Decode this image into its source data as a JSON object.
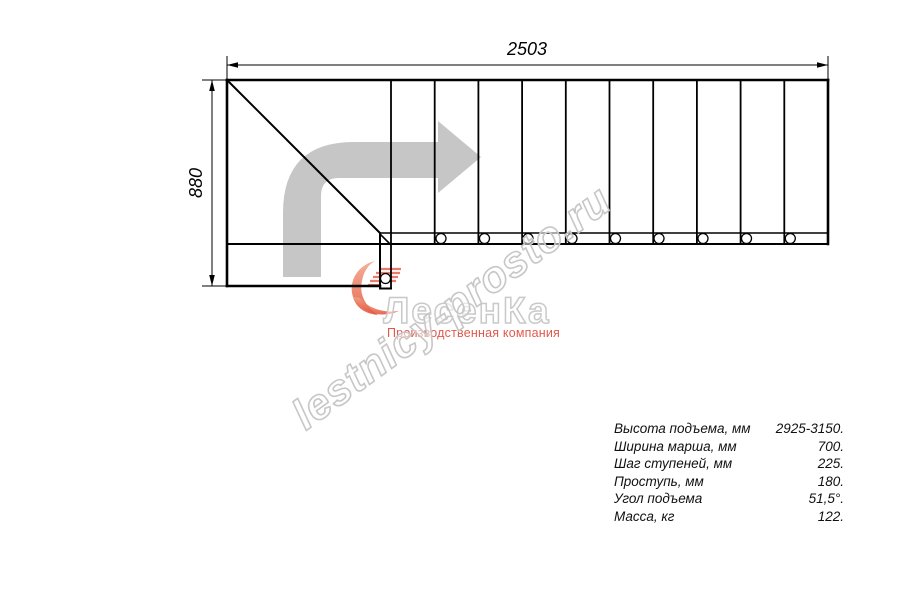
{
  "drawing": {
    "width_label": "2503",
    "height_label": "880",
    "line_color": "#000000",
    "direction_arrow_color": "#c6c6c6"
  },
  "watermark": {
    "text": "lestnicy-prosto.ru",
    "outline_color": "#c7c7c7"
  },
  "logo": {
    "name": "ЛесенКа",
    "tagline": "Производственная компания",
    "tagline_color": "#e0594c",
    "swoosh_color": "#e25038",
    "outline_color": "#c9c9c9"
  },
  "specs": {
    "rows": [
      {
        "label": "Высота подъема, мм",
        "value": "2925-3150."
      },
      {
        "label": "Ширина марша, мм",
        "value": "700."
      },
      {
        "label": "Шаг ступеней, мм",
        "value": "225."
      },
      {
        "label": "Проступь, мм",
        "value": "180."
      },
      {
        "label": "Угол подъема",
        "value": "51,5°."
      },
      {
        "label": "Масса, кг",
        "value": "122."
      }
    ]
  }
}
